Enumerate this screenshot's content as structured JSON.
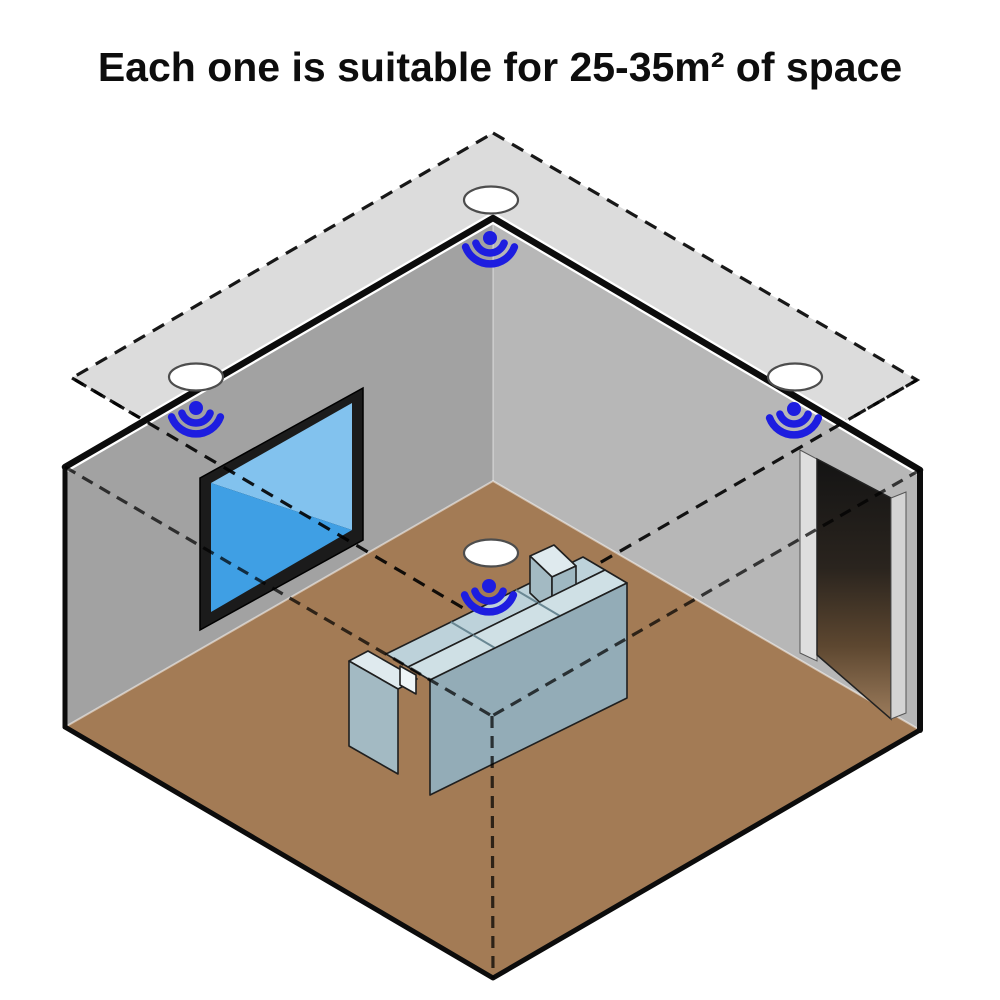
{
  "title": "Each one is suitable for 25-35m² of space",
  "colors": {
    "accent_blue": "#1d1de0",
    "ceiling_plane": "#dcdcdc",
    "wall_left": "#a2a2a2",
    "wall_right": "#b7b7b7",
    "floor": "#a37b55",
    "tv_frame": "#1b1b1b",
    "tv_screen": "#3f9fe4",
    "tv_screen_highlight": "#82c2ee",
    "sofa_back": "#93acb7",
    "sofa_rail": "#cfe0e5",
    "sofa_seat": "#bdd2da",
    "sofa_arm_top": "#dfeaee",
    "sofa_arm_side": "#a3bac3",
    "sofa_arm_block": "#9fb8c2",
    "door_jamb": "#dedede",
    "lamp_fill": "#ffffff",
    "outline": "#000000"
  },
  "illustration": {
    "type": "isometric-room-coverage-diagram",
    "lamp_count": 4,
    "lamps": [
      {
        "name": "ceiling-lamp-back-corner"
      },
      {
        "name": "ceiling-lamp-left"
      },
      {
        "name": "ceiling-lamp-right"
      },
      {
        "name": "ceiling-lamp-center"
      }
    ],
    "objects": [
      "ceiling-plane",
      "left-wall",
      "right-wall",
      "floor",
      "tv",
      "sofa",
      "doorway"
    ]
  }
}
